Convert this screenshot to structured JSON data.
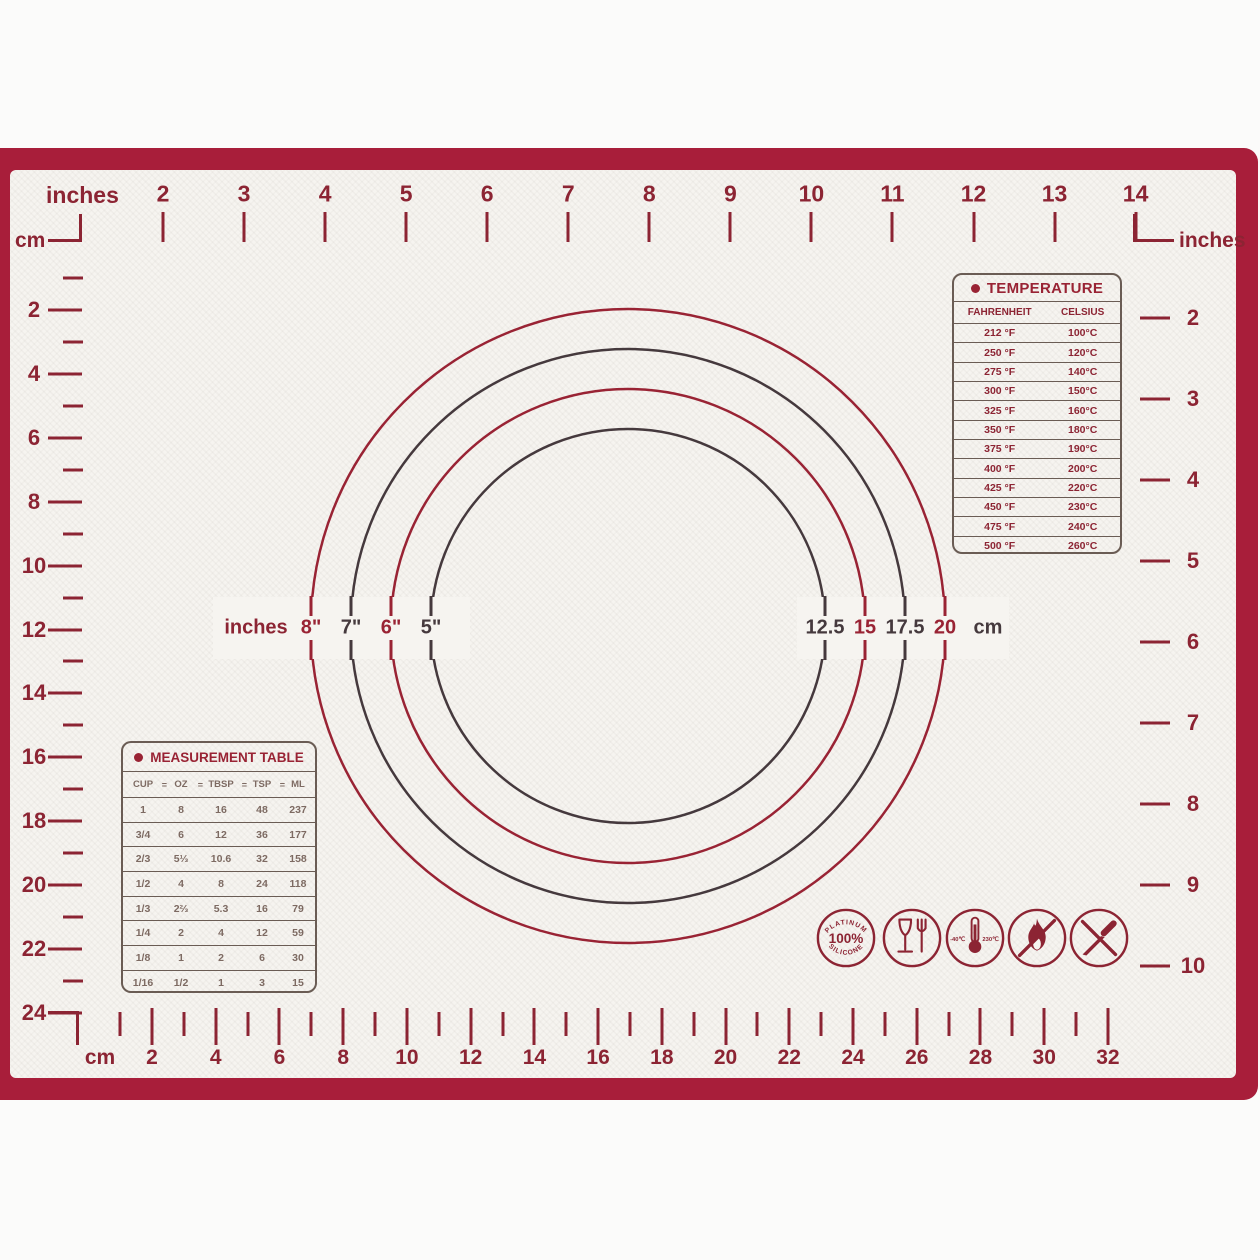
{
  "colors": {
    "frame_red": "#a81e3a",
    "print_red": "#8c2433",
    "circle_red": "#992334",
    "circle_dark": "#45393d",
    "table_line": "#6a5c54",
    "value_brown": "#7d6a62",
    "mat_white": "#f6f4f0"
  },
  "rulers": {
    "top": {
      "unit": "inches",
      "numbers": [
        "2",
        "3",
        "4",
        "5",
        "6",
        "7",
        "8",
        "9",
        "10",
        "11",
        "12",
        "13",
        "14"
      ]
    },
    "left": {
      "unit": "cm",
      "numbers": [
        "2",
        "4",
        "6",
        "8",
        "10",
        "12",
        "14",
        "16",
        "18",
        "20",
        "22",
        "24"
      ]
    },
    "right": {
      "unit": "inches",
      "numbers": [
        "2",
        "3",
        "4",
        "5",
        "6",
        "7",
        "8",
        "9",
        "10"
      ]
    },
    "bottom": {
      "unit": "cm",
      "numbers": [
        "2",
        "4",
        "6",
        "8",
        "10",
        "12",
        "14",
        "16",
        "18",
        "20",
        "22",
        "24",
        "26",
        "28",
        "30",
        "32"
      ]
    }
  },
  "circles": {
    "left_unit": "inches",
    "left_labels": [
      "8\"",
      "7\"",
      "6\"",
      "5\""
    ],
    "right_labels": [
      "12.5",
      "15",
      "17.5",
      "20"
    ],
    "right_unit": "cm"
  },
  "temperature_table": {
    "title": "TEMPERATURE",
    "col_fahrenheit": "FAHRENHEIT",
    "col_celsius": "CELSIUS",
    "rows": [
      [
        "212 °F",
        "100°C"
      ],
      [
        "250 °F",
        "120°C"
      ],
      [
        "275 °F",
        "140°C"
      ],
      [
        "300 °F",
        "150°C"
      ],
      [
        "325 °F",
        "160°C"
      ],
      [
        "350 °F",
        "180°C"
      ],
      [
        "375 °F",
        "190°C"
      ],
      [
        "400 °F",
        "200°C"
      ],
      [
        "425 °F",
        "220°C"
      ],
      [
        "450 °F",
        "230°C"
      ],
      [
        "475 °F",
        "240°C"
      ],
      [
        "500 °F",
        "260°C"
      ]
    ]
  },
  "measurement_table": {
    "title": "MEASUREMENT TABLE",
    "separator": "=",
    "headers": [
      "CUP",
      "OZ",
      "TBSP",
      "TSP",
      "ML"
    ],
    "rows": [
      [
        "1",
        "8",
        "16",
        "48",
        "237"
      ],
      [
        "3/4",
        "6",
        "12",
        "36",
        "177"
      ],
      [
        "2/3",
        "5⅓",
        "10.6",
        "32",
        "158"
      ],
      [
        "1/2",
        "4",
        "8",
        "24",
        "118"
      ],
      [
        "1/3",
        "2⅔",
        "5.3",
        "16",
        "79"
      ],
      [
        "1/4",
        "2",
        "4",
        "12",
        "59"
      ],
      [
        "1/8",
        "1",
        "2",
        "6",
        "30"
      ],
      [
        "1/16",
        "1/2",
        "1",
        "3",
        "15"
      ]
    ]
  },
  "icons": {
    "badge": {
      "top": "PLATINUM",
      "center": "100%",
      "bottom": "SILICONE"
    },
    "thermometer": {
      "left": "-40℃",
      "right": "230℃"
    }
  }
}
